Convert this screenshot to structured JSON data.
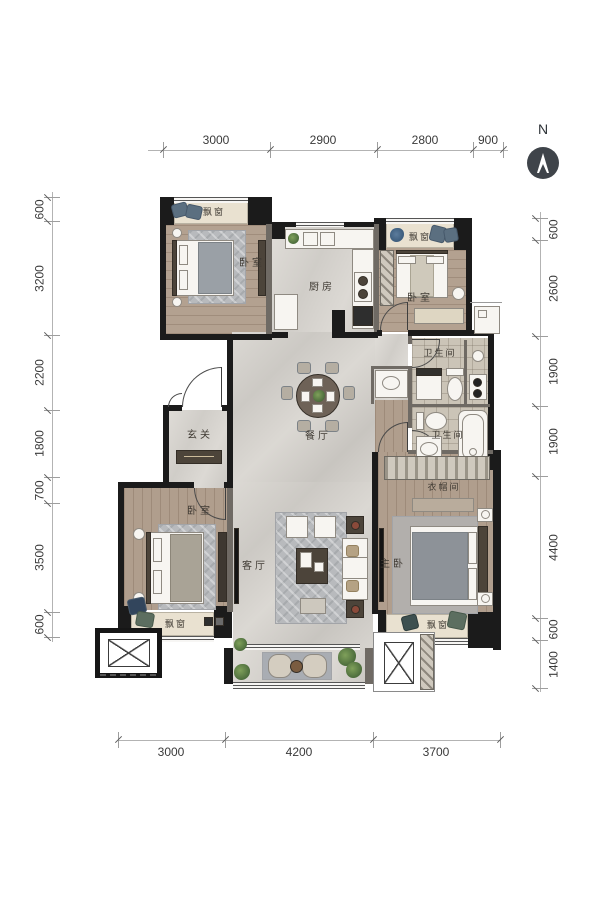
{
  "compass": {
    "n": "N"
  },
  "dims": {
    "top": [
      "3000",
      "2900",
      "2800",
      "900"
    ],
    "bottom": [
      "3000",
      "4200",
      "3700"
    ],
    "left": [
      "600",
      "3200",
      "2200",
      "1800",
      "700",
      "3500",
      "600"
    ],
    "right": [
      "600",
      "2600",
      "1900",
      "1900",
      "4400",
      "600",
      "1400"
    ]
  },
  "rooms": {
    "bedroom_tl": "卧室",
    "bay_tl": "飘窗",
    "kitchen": "厨房",
    "bedroom_tr": "卧室",
    "bay_tr": "飘窗",
    "bath_upper": "卫生间",
    "bath_lower": "卫生间",
    "foyer": "玄关",
    "dining": "餐厅",
    "bedroom_bl": "卧室",
    "bay_bl": "飘窗",
    "living": "客厅",
    "closet": "衣帽间",
    "master": "主卧",
    "bay_master": "飘窗"
  },
  "colors": {
    "wall": "#1b1b1b",
    "partition": "#6f6a64",
    "marble_floor": "#d4d1cc",
    "wood_floor": "#b3a190",
    "bay_fill": "#e9e1d0",
    "compass": "#3f444a",
    "dim_text": "#3a3a3a"
  }
}
